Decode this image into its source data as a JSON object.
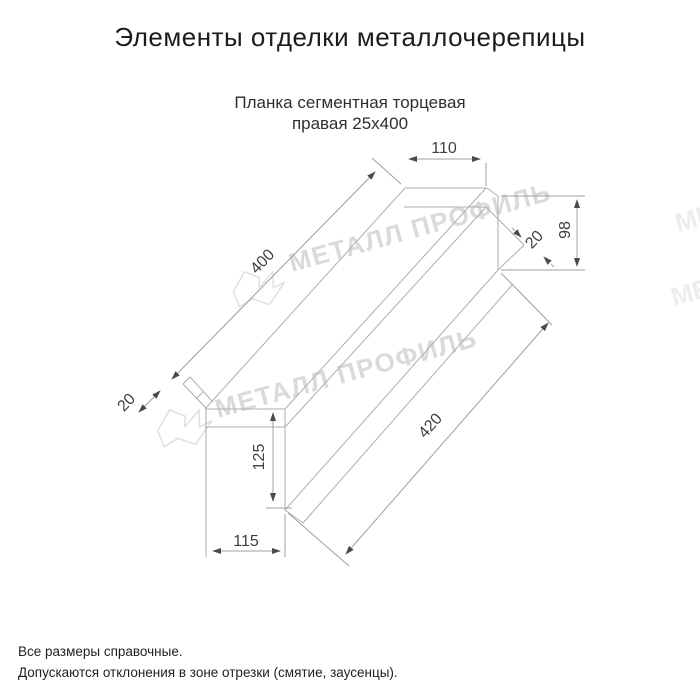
{
  "title": "Элементы отделки металлочерепицы",
  "subtitle": {
    "line1": "Планка сегментная торцевая",
    "line2": "правая 25х400"
  },
  "dims": {
    "width_top": "110",
    "height_right": "98",
    "hem_right": "20",
    "length_top": "400",
    "hem_left": "20",
    "length_bottom": "420",
    "height_left": "125",
    "width_bottom": "115"
  },
  "watermark": {
    "text": "МЕТАЛЛ ПРОФИЛЬ"
  },
  "footer": {
    "line1": "Все размеры справочные.",
    "line2": "Допускаются отклонения в зоне отрезки (смятие, заусенцы)."
  },
  "colors": {
    "line": "#aeaeae",
    "dim_text": "#3f3f3f",
    "watermark": "#dadada"
  }
}
